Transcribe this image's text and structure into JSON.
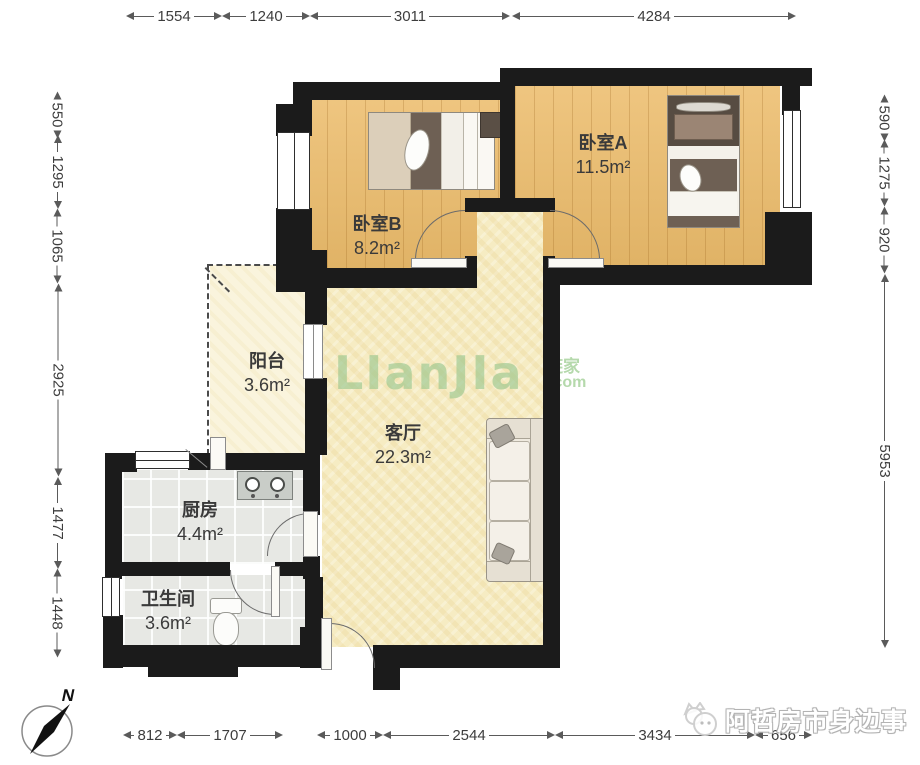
{
  "rooms": [
    {
      "name": "卧室A",
      "area": "11.5m²"
    },
    {
      "name": "卧室B",
      "area": "8.2m²"
    },
    {
      "name": "阳台",
      "area": "3.6m²"
    },
    {
      "name": "客厅",
      "area": "22.3m²"
    },
    {
      "name": "厨房",
      "area": "4.4m²"
    },
    {
      "name": "卫生间",
      "area": "3.6m²"
    }
  ],
  "dimensions": {
    "top": [
      "1554",
      "1240",
      "3011",
      "4284"
    ],
    "left": [
      "550",
      "1295",
      "1065",
      "2925",
      "1477",
      "1448"
    ],
    "right": [
      "590",
      "1275",
      "920",
      "5953"
    ],
    "bottom": [
      "812",
      "1707",
      "1000",
      "2544",
      "3434",
      "656"
    ]
  },
  "watermark": {
    "logo": "LIanJIa",
    "logo_cn": "链家",
    "logo_domain": ".com",
    "badge": "阿哲房市身边事"
  },
  "compass": {
    "north_label": "N"
  },
  "colors": {
    "wall": "#1b1b1b",
    "wood_floor": "#ecbc6b",
    "living_floor": "#f6ecc3",
    "tile_floor": "#e7e8e4",
    "balcony_floor": "#faf4dd",
    "lianjia_green": "#a6cf9e"
  }
}
